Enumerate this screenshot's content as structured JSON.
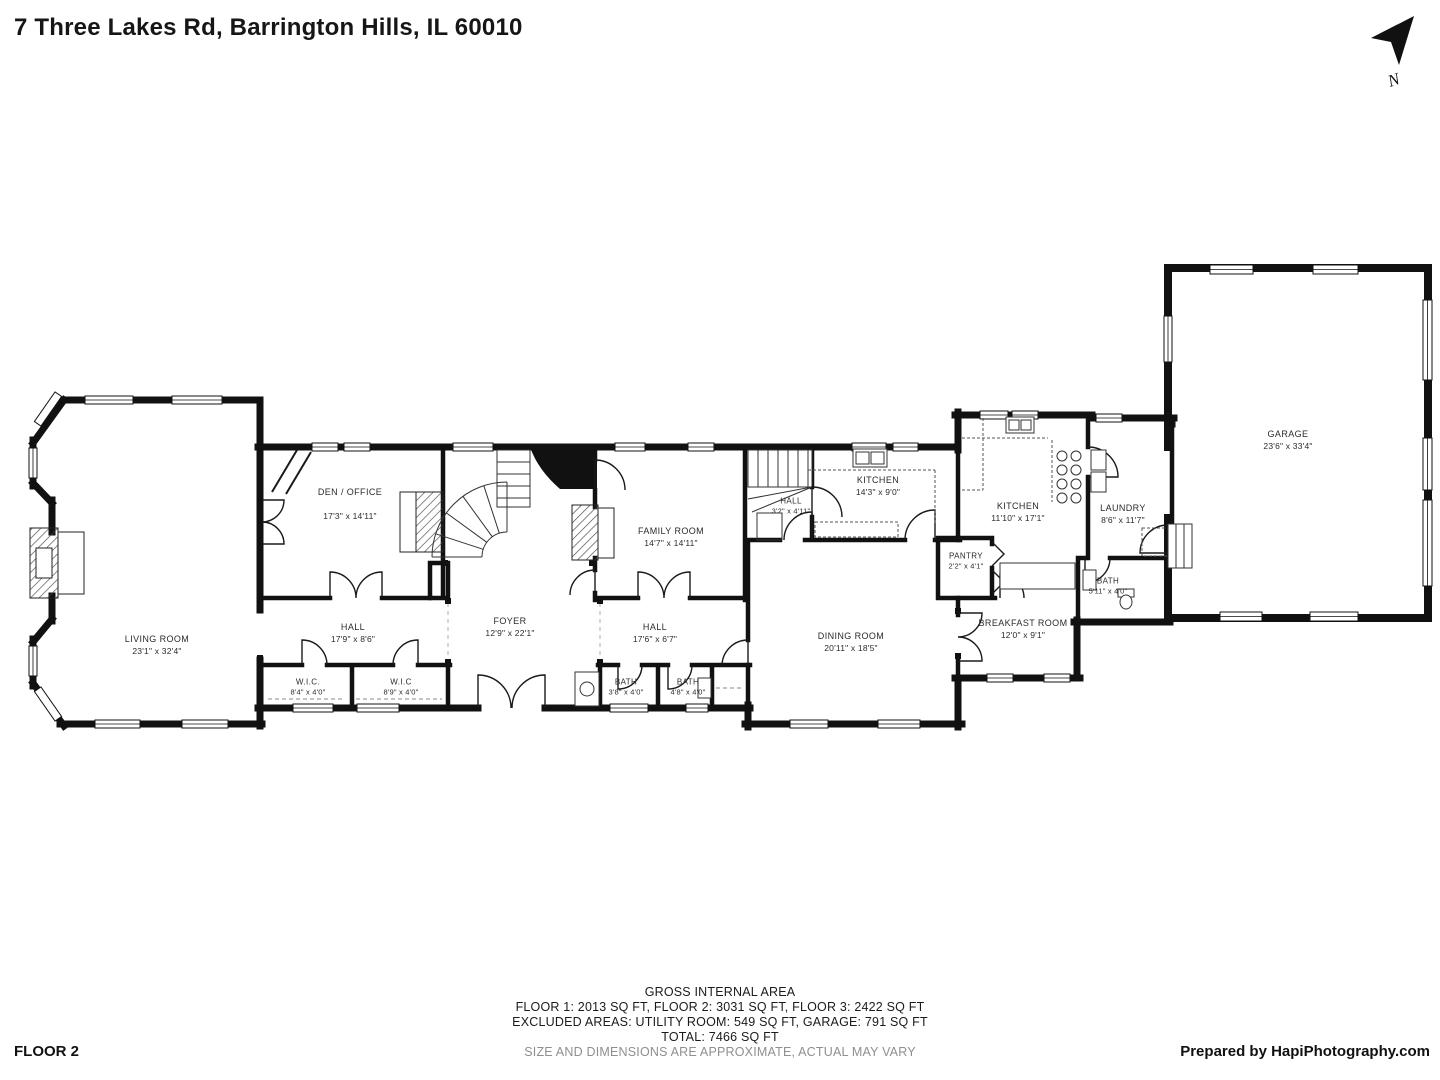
{
  "header": {
    "address": "7 Three Lakes Rd, Barrington Hills, IL 60010"
  },
  "compass": {
    "label": "N"
  },
  "rooms": {
    "living": {
      "name": "LIVING ROOM",
      "dims": "23'1\" x 32'4\""
    },
    "den": {
      "name": "DEN / OFFICE",
      "dims": "17'3\" x 14'11\""
    },
    "foyer": {
      "name": "FOYER",
      "dims": "12'9\" x 22'1\""
    },
    "family": {
      "name": "FAMILY ROOM",
      "dims": "14'7\" x 14'11\""
    },
    "hall_stairs": {
      "name": "HALL",
      "dims": "3'2\" x 4'11\""
    },
    "kitchen_small": {
      "name": "KITCHEN",
      "dims": "14'3\" x 9'0\""
    },
    "kitchen_main": {
      "name": "KITCHEN",
      "dims": "11'10\" x 17'1\""
    },
    "laundry": {
      "name": "LAUNDRY",
      "dims": "8'6\" x 11'7\""
    },
    "pantry": {
      "name": "PANTRY",
      "dims": "2'2\" x 4'1\""
    },
    "bath_right": {
      "name": "BATH",
      "dims": "5'11\" x 4'0\""
    },
    "dining": {
      "name": "DINING ROOM",
      "dims": "20'11\" x 18'5\""
    },
    "breakfast": {
      "name": "BREAKFAST ROOM",
      "dims": "12'0\" x 9'1\""
    },
    "garage": {
      "name": "GARAGE",
      "dims": "23'6\" x 33'4\""
    },
    "hall_left": {
      "name": "HALL",
      "dims": "17'9\" x 8'6\""
    },
    "hall_right": {
      "name": "HALL",
      "dims": "17'6\" x 6'7\""
    },
    "wic_left": {
      "name": "W.I.C.",
      "dims": "8'4\" x 4'0\""
    },
    "wic_right": {
      "name": "W.I.C",
      "dims": "8'9\" x 4'0\""
    },
    "bath_1": {
      "name": "BATH",
      "dims": "3'8\" x 4'0\""
    },
    "bath_2": {
      "name": "BATH",
      "dims": "4'8\" x 4'0\""
    }
  },
  "footer": {
    "floor_label": "FLOOR 2",
    "credit": "Prepared by HapiPhotography.com",
    "area_summary": {
      "line1": "GROSS INTERNAL AREA",
      "line2": "FLOOR 1: 2013 SQ FT, FLOOR 2: 3031 SQ FT, FLOOR 3: 2422 SQ FT",
      "line3": "EXCLUDED AREAS: UTILITY ROOM: 549 SQ FT, GARAGE: 791 SQ FT",
      "line4": "TOTAL: 7466 SQ FT",
      "line5": "SIZE AND DIMENSIONS ARE APPROXIMATE, ACTUAL MAY VARY"
    }
  },
  "colors": {
    "wall": "#111111",
    "text": "#2b2b2b",
    "muted": "#8f8f8f"
  }
}
